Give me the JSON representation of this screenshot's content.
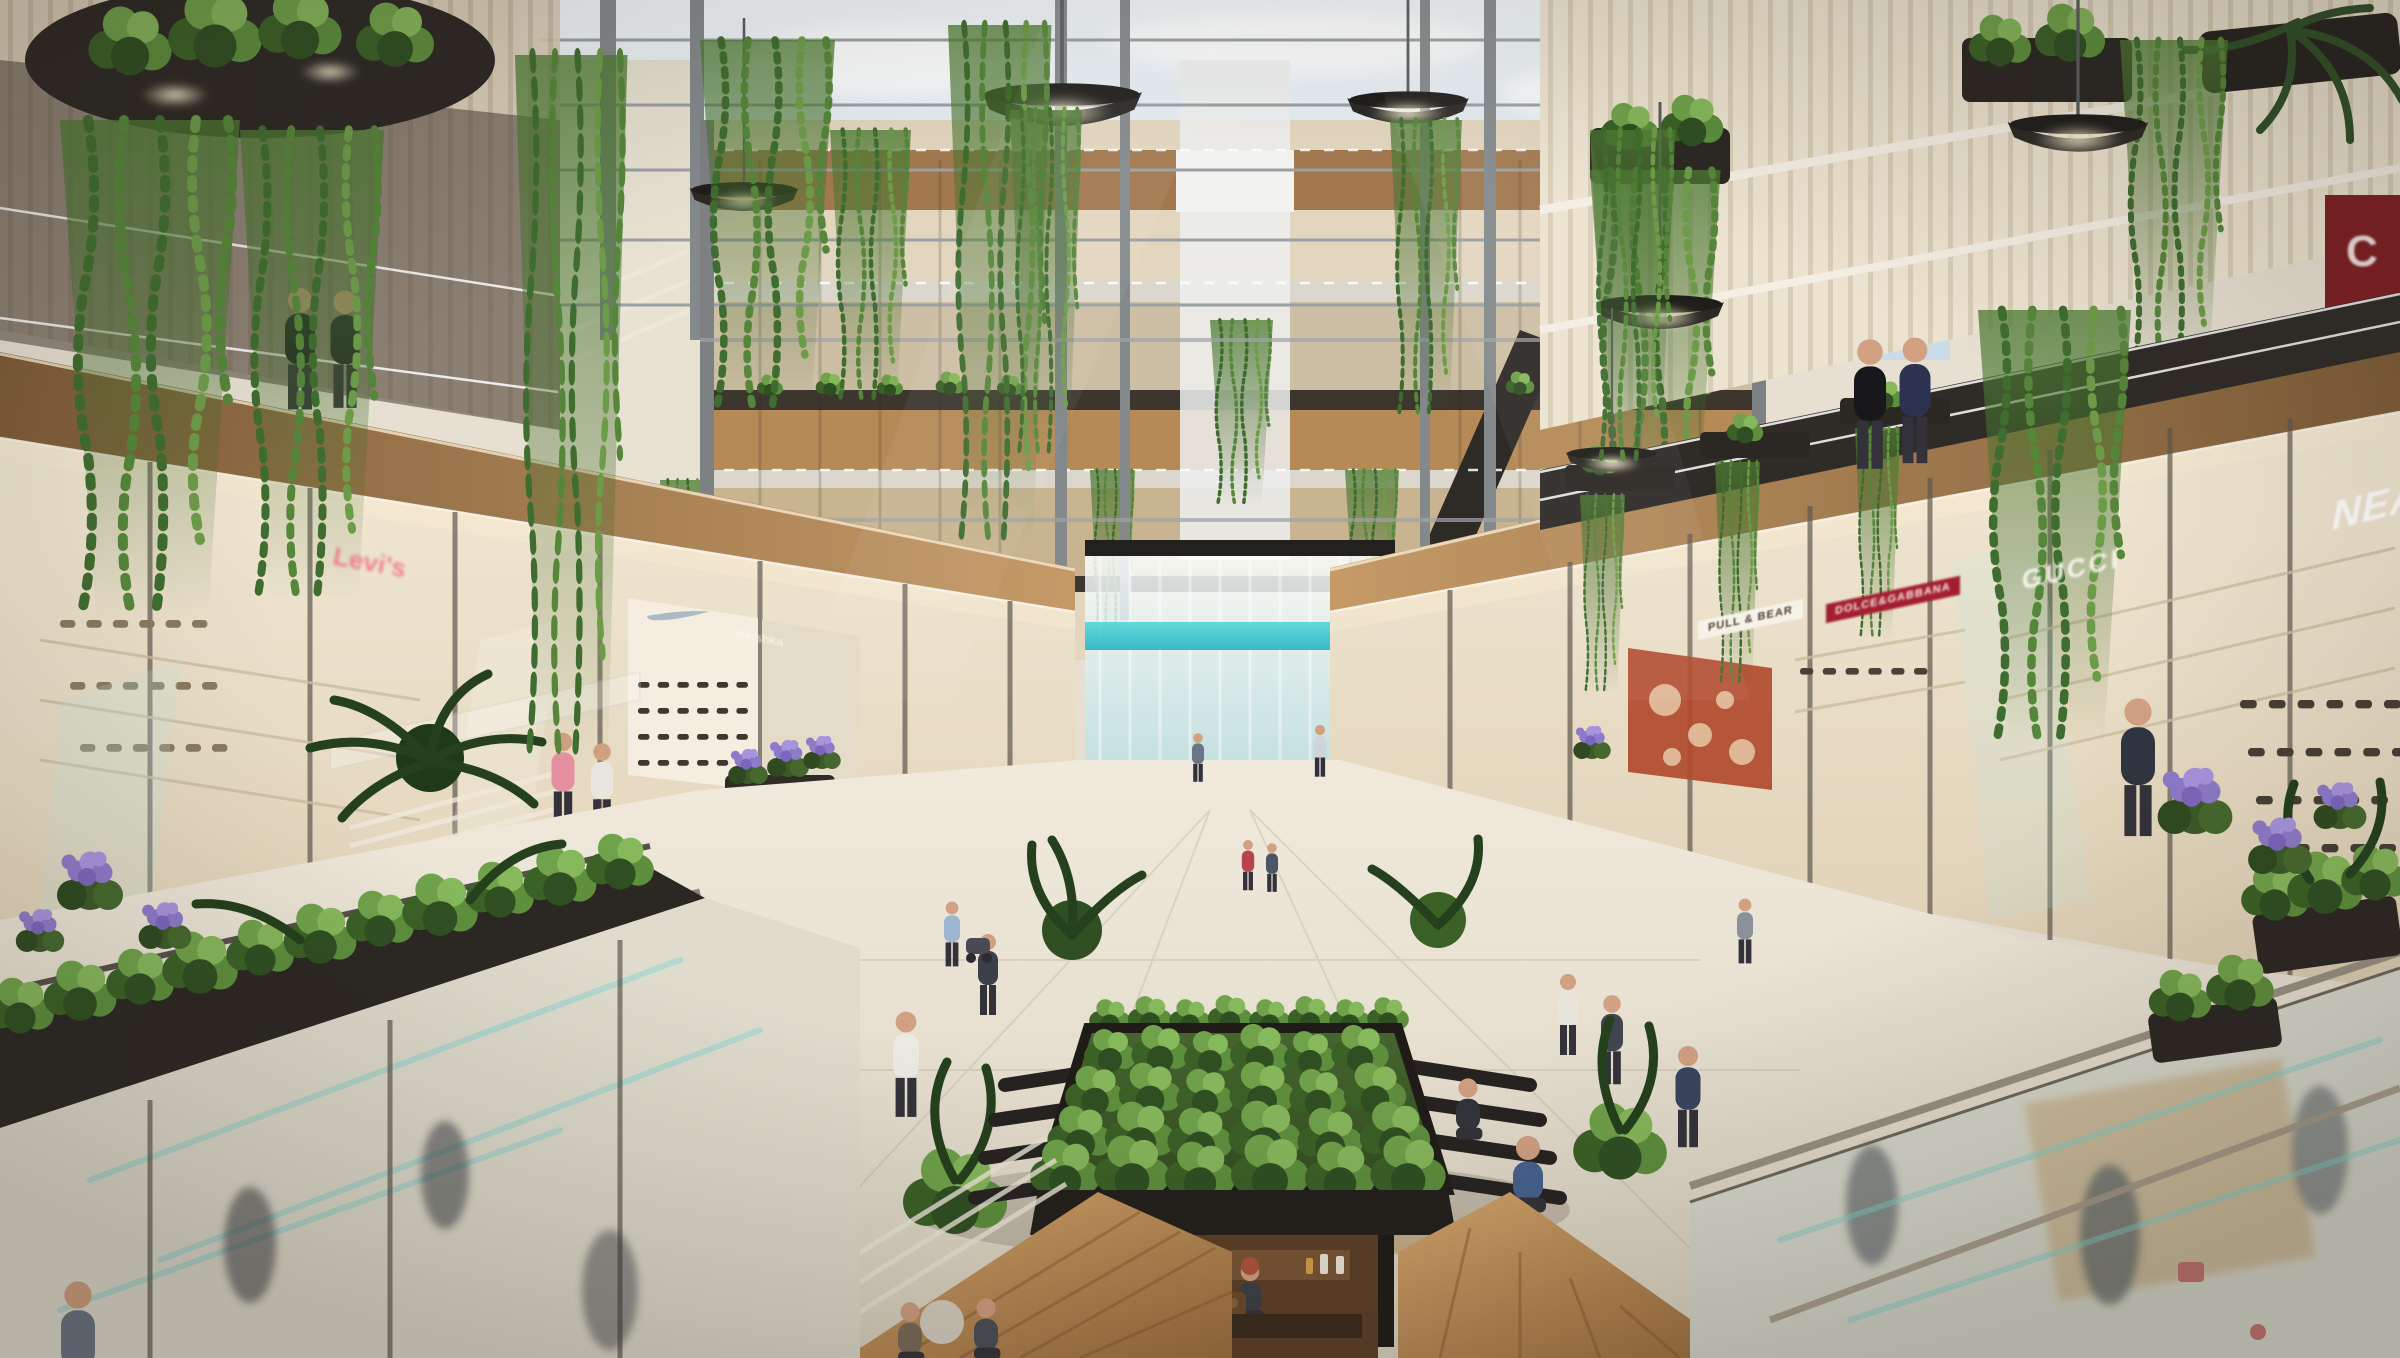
{
  "image": {
    "scene_type": "shopping-mall-atrium-architectural-rendering",
    "signs": {
      "levis": "Levi's",
      "bershka": "Bershka",
      "pull_and_bear": "PULL & BEAR",
      "dolce_gabbana": "DOLCE&GABBANA",
      "gucci": "GUCCI",
      "nea_partial": "NEA",
      "c_partial": "C"
    },
    "icons": {
      "nike_swoosh": "nike-swoosh-icon"
    },
    "palette": {
      "sky": "#e9f1f5",
      "steel": "#84898c",
      "wood_warm": "#b08455",
      "wood_deck": "#c89a66",
      "beige_interior": "#ece2cc",
      "planter_dark": "#2b2723",
      "foliage_dark": "#2f4f22",
      "foliage_mid": "#4d7a33",
      "foliage_light": "#7fae53",
      "waterfall_teal": "#45c8d0",
      "stone_floor": "#ece6d9",
      "red_sign": "#a31f30",
      "display_red": "#b14a2e",
      "flower_purple": "#8d7ac9",
      "sign_pink": "#ef6a80"
    }
  }
}
